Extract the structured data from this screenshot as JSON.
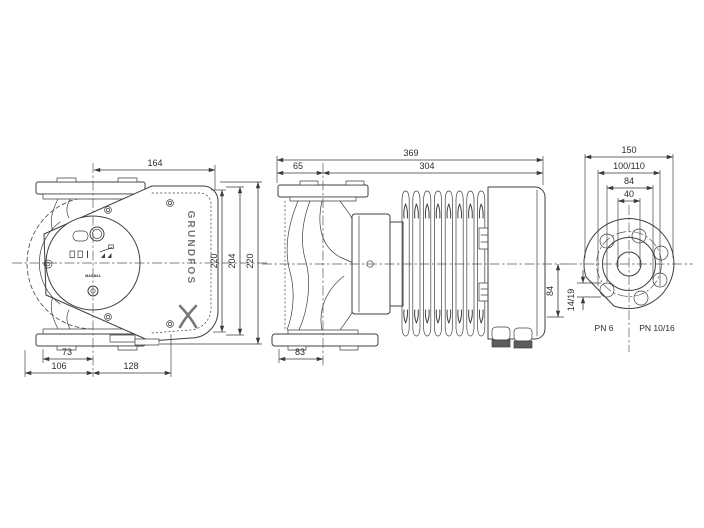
{
  "title": "Pump dimensional drawing",
  "brand": {
    "logo_text": "GRUNDFOS",
    "model": "MAGNA1"
  },
  "front_view": {
    "dims": {
      "top_width": "164",
      "box_height": "220",
      "mid_height": "204",
      "total_height": "220",
      "bottom_inner": "73",
      "bottom_left": "106",
      "bottom_right": "128"
    }
  },
  "side_view": {
    "dims": {
      "total_length": "369",
      "left_segment": "65",
      "right_segment": "304",
      "bottom_width": "83",
      "axis_to_bottom": "84"
    }
  },
  "flange_view": {
    "dims": {
      "outer_diameter": "150",
      "bolt_circle": "100/110",
      "hub_diameter": "84",
      "bore_diameter": "40",
      "hole_diameter": "14/19"
    },
    "labels": {
      "pn_left": "PN 6",
      "pn_right": "PN 10/16"
    }
  }
}
